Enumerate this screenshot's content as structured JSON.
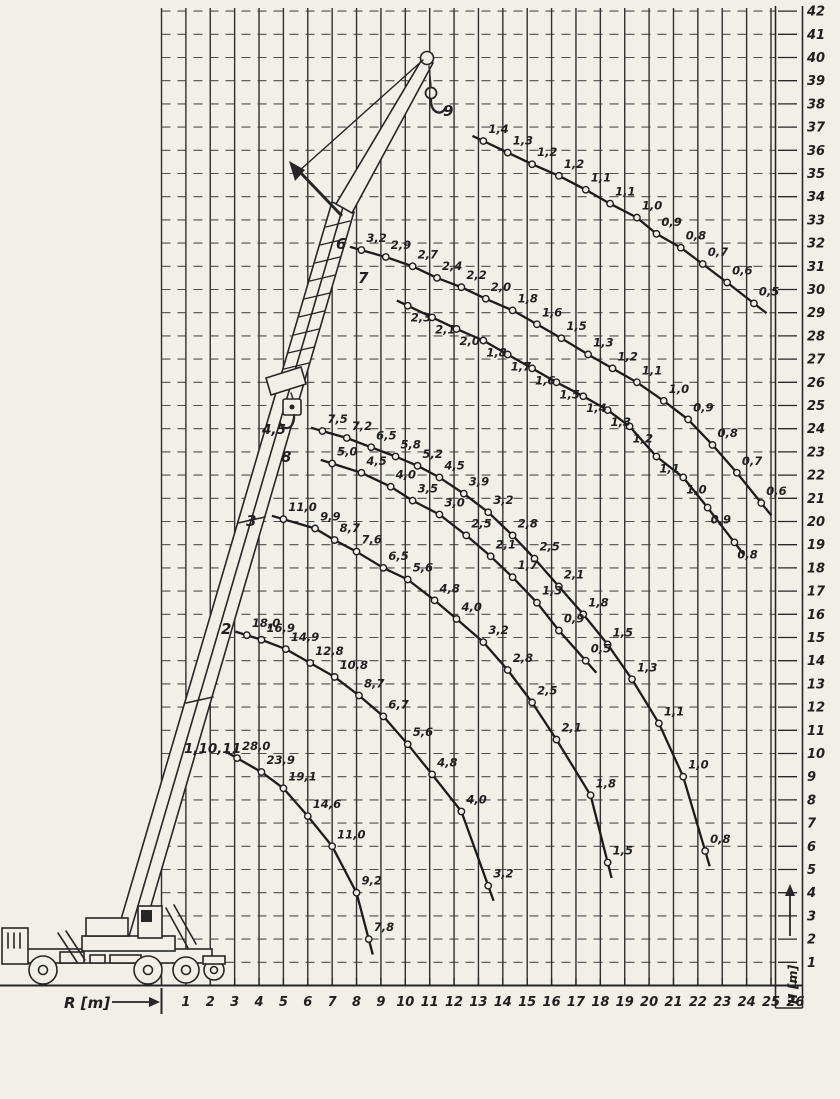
{
  "scan": {
    "paper_color": "#f2efe8",
    "ink_color": "#262626"
  },
  "chart_data": {
    "type": "line",
    "description": "Mobile telescopic crane load capacity curves: hook load (t) labels plotted over working radius R and hook height H for boom/jib configurations",
    "xlabel": "R [m]",
    "ylabel": "H [m]",
    "xlim": [
      0,
      26
    ],
    "ylim": [
      0,
      42
    ],
    "grid": "vertical solid lines, horizontal dashed lines, 1 m spacing",
    "legend_position": "curve labels inline at curve start",
    "x_ticks": [
      1,
      2,
      3,
      4,
      5,
      6,
      7,
      8,
      9,
      10,
      11,
      12,
      13,
      14,
      15,
      16,
      17,
      18,
      19,
      20,
      21,
      22,
      23,
      24,
      25,
      26
    ],
    "y_ticks": [
      1,
      2,
      3,
      4,
      5,
      6,
      7,
      8,
      9,
      10,
      11,
      12,
      13,
      14,
      15,
      16,
      17,
      18,
      19,
      20,
      21,
      22,
      23,
      24,
      25,
      26,
      27,
      28,
      29,
      30,
      31,
      32,
      33,
      34,
      35,
      36,
      37,
      38,
      39,
      40,
      41,
      42
    ],
    "series": [
      {
        "name": "9",
        "label_px": [
          443,
          116
        ],
        "R": [
          13.2,
          14.2,
          15.2,
          16.3,
          17.4,
          18.4,
          19.5,
          20.3,
          21.3,
          22.2,
          23.2,
          24.3
        ],
        "H": [
          36.4,
          35.9,
          35.4,
          34.9,
          34.3,
          33.7,
          33.1,
          32.4,
          31.8,
          31.1,
          30.3,
          29.4
        ],
        "loads": [
          1.4,
          1.3,
          1.2,
          1.2,
          1.1,
          1.1,
          1.0,
          0.9,
          0.8,
          0.7,
          0.6,
          0.5
        ]
      },
      {
        "name": "6",
        "label_px": [
          336,
          249
        ],
        "R": [
          8.2,
          9.2,
          10.3,
          11.3,
          12.3,
          13.3,
          14.4,
          15.4,
          16.4,
          17.5,
          18.5,
          19.5,
          20.6,
          21.6,
          22.6,
          23.6,
          24.6
        ],
        "H": [
          31.7,
          31.4,
          31.0,
          30.5,
          30.1,
          29.6,
          29.1,
          28.5,
          27.9,
          27.2,
          26.6,
          26.0,
          25.2,
          24.4,
          23.3,
          22.1,
          20.8
        ],
        "loads": [
          3.2,
          2.9,
          2.7,
          2.4,
          2.2,
          2.0,
          1.8,
          1.6,
          1.5,
          1.3,
          1.2,
          1.1,
          1.0,
          0.9,
          0.8,
          0.7,
          0.6
        ]
      },
      {
        "name": "7",
        "label_px": [
          358,
          283
        ],
        "R": [
          10.1,
          11.1,
          12.1,
          13.2,
          14.2,
          15.2,
          16.2,
          17.3,
          18.3,
          19.2,
          20.3,
          21.4,
          22.4,
          23.5
        ],
        "H": [
          29.3,
          28.8,
          28.3,
          27.8,
          27.2,
          26.6,
          26.0,
          25.4,
          24.8,
          24.1,
          22.8,
          21.9,
          20.6,
          19.1
        ],
        "loads": [
          2.3,
          2.1,
          2.0,
          1.8,
          1.7,
          1.6,
          1.5,
          1.4,
          1.3,
          1.2,
          1.1,
          1.0,
          0.9,
          0.8
        ]
      },
      {
        "name": "4,5",
        "label_px": [
          262,
          434
        ],
        "R": [
          6.6,
          7.6,
          8.6,
          9.6,
          10.5,
          11.4,
          12.4,
          13.4,
          14.4,
          15.3,
          16.3,
          17.3,
          18.3,
          19.3,
          20.4,
          21.4,
          22.3
        ],
        "H": [
          23.9,
          23.6,
          23.2,
          22.8,
          22.4,
          21.9,
          21.2,
          20.4,
          19.4,
          18.4,
          17.2,
          16.0,
          14.7,
          13.2,
          11.3,
          9.0,
          5.8
        ],
        "loads": [
          7.5,
          7.2,
          6.5,
          5.8,
          5.2,
          4.5,
          3.9,
          3.2,
          2.8,
          2.5,
          2.1,
          1.8,
          1.5,
          1.3,
          1.1,
          1.0,
          0.8
        ]
      },
      {
        "name": "8",
        "label_px": [
          281,
          462
        ],
        "R": [
          7.0,
          8.2,
          9.4,
          10.3,
          11.4,
          12.5,
          13.5,
          14.4,
          15.4,
          16.3,
          17.4
        ],
        "H": [
          22.5,
          22.1,
          21.5,
          20.9,
          20.3,
          19.4,
          18.5,
          17.6,
          16.5,
          15.3,
          14.0
        ],
        "loads": [
          5.0,
          4.5,
          4.0,
          3.5,
          3.0,
          2.5,
          2.1,
          1.7,
          1.3,
          0.9,
          0.5
        ]
      },
      {
        "name": "3",
        "label_px": [
          246,
          526
        ],
        "R": [
          5.0,
          6.3,
          7.1,
          8.0,
          9.1,
          10.1,
          11.2,
          12.1,
          13.2,
          14.2,
          15.2,
          16.2,
          17.6,
          18.3
        ],
        "H": [
          20.1,
          19.7,
          19.2,
          18.7,
          18.0,
          17.5,
          16.6,
          15.8,
          14.8,
          13.6,
          12.2,
          10.6,
          8.2,
          5.3
        ],
        "loads": [
          11.0,
          9.9,
          8.7,
          7.6,
          6.5,
          5.6,
          4.8,
          4.0,
          3.2,
          2.8,
          2.5,
          2.1,
          1.8,
          1.5
        ]
      },
      {
        "name": "2",
        "label_px": [
          221,
          634
        ],
        "R": [
          3.5,
          4.1,
          5.1,
          6.1,
          7.1,
          8.1,
          9.1,
          10.1,
          11.1,
          12.3,
          13.4
        ],
        "H": [
          15.1,
          14.9,
          14.5,
          13.9,
          13.3,
          12.5,
          11.6,
          10.4,
          9.1,
          7.5,
          4.3
        ],
        "loads": [
          18.0,
          16.9,
          14.9,
          12.8,
          10.8,
          8.7,
          6.7,
          5.6,
          4.8,
          4.0,
          3.2
        ]
      },
      {
        "name": "1,10,11",
        "label_px": [
          184,
          753
        ],
        "R": [
          3.1,
          4.1,
          5.0,
          6.0,
          7.0,
          8.0,
          8.5
        ],
        "H": [
          9.8,
          9.2,
          8.5,
          7.3,
          6.0,
          4.0,
          2.0
        ],
        "loads": [
          28.0,
          23.9,
          19.1,
          14.6,
          11.0,
          9.2,
          7.8
        ]
      }
    ]
  }
}
